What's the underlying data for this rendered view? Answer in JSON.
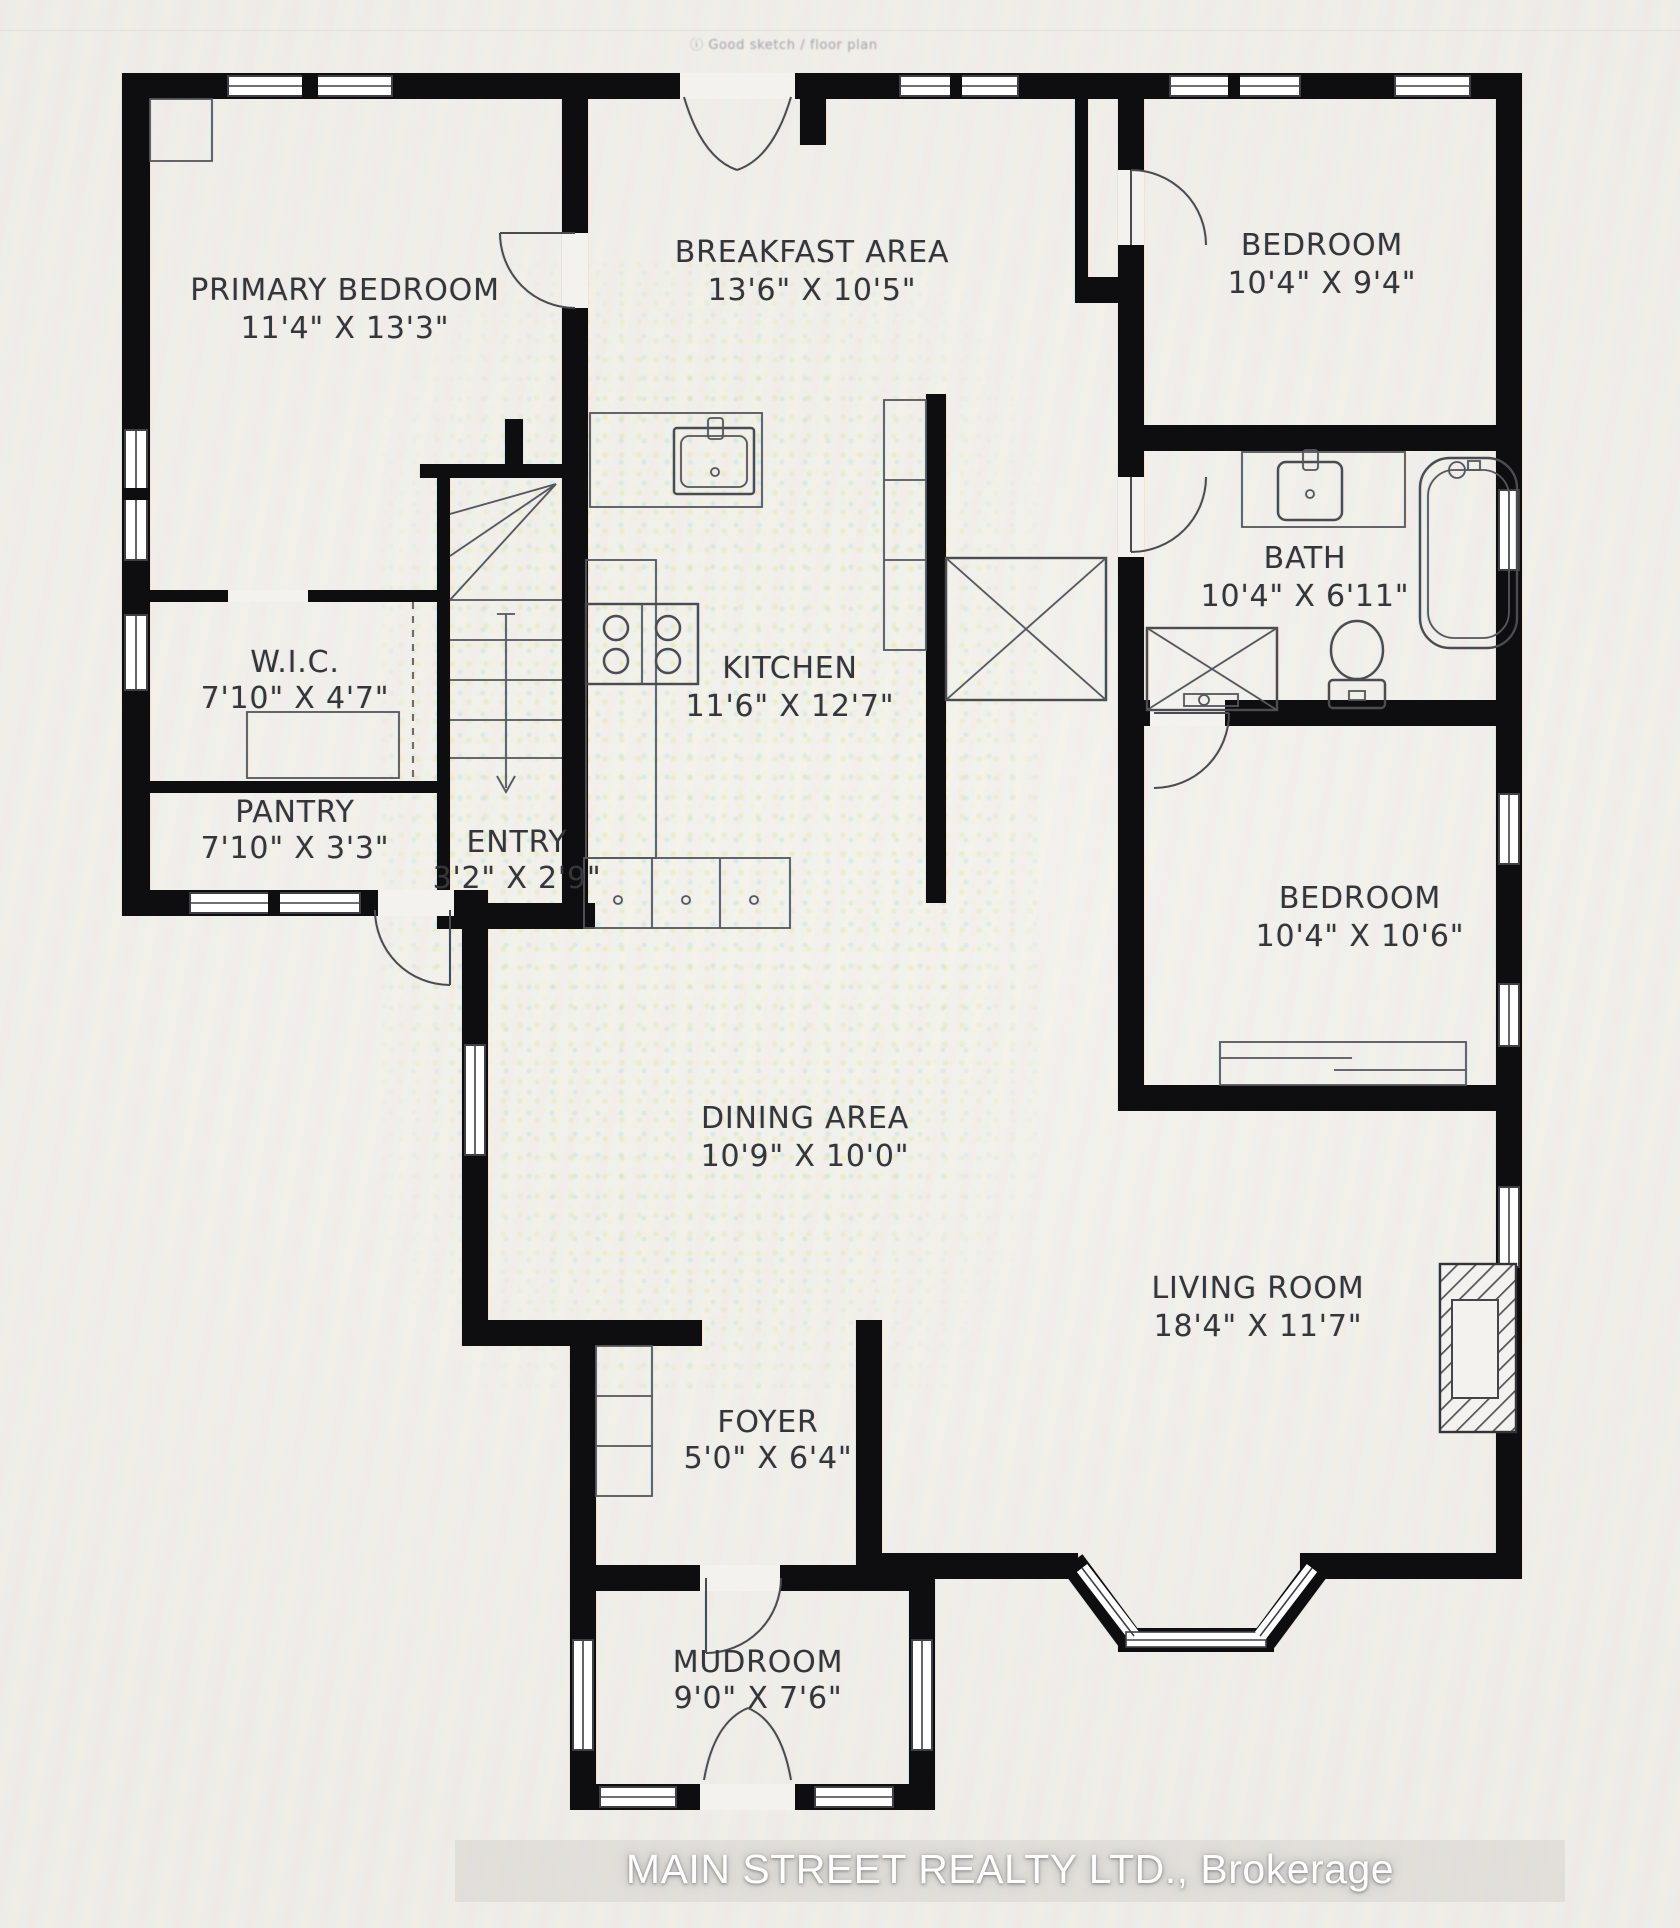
{
  "watermark": "ⓘ Good sketch  /  floor plan",
  "rooms": [
    {
      "name": "PRIMARY BEDROOM",
      "size": "11'4\" X 13'3\""
    },
    {
      "name": "BREAKFAST AREA",
      "size": "13'6\" X 10'5\""
    },
    {
      "name": "BEDROOM",
      "size": "10'4\" X 9'4\""
    },
    {
      "name": "BATH",
      "size": "10'4\" X 6'11\""
    },
    {
      "name": "W.I.C.",
      "size": "7'10\" X 4'7\""
    },
    {
      "name": "KITCHEN",
      "size": "11'6\" X 12'7\""
    },
    {
      "name": "PANTRY",
      "size": "7'10\" X 3'3\""
    },
    {
      "name": "ENTRY",
      "size": "3'2\" X 2'9\""
    },
    {
      "name": "BEDROOM",
      "size": "10'4\" X 10'6\""
    },
    {
      "name": "DINING AREA",
      "size": "10'9\" X 10'0\""
    },
    {
      "name": "LIVING ROOM",
      "size": "18'4\" X 11'7\""
    },
    {
      "name": "FOYER",
      "size": "5'0\" X 6'4\""
    },
    {
      "name": "MUDROOM",
      "size": "9'0\" X 7'6\""
    }
  ],
  "footer": {
    "brokerage": "MAIN STREET REALTY LTD., Brokerage"
  },
  "colors": {
    "wall": "#0e0e10",
    "label": "#35363c",
    "fixture_line": "#4a4c52",
    "footer_text": "#fefefe",
    "background": "#f4f2ee"
  }
}
